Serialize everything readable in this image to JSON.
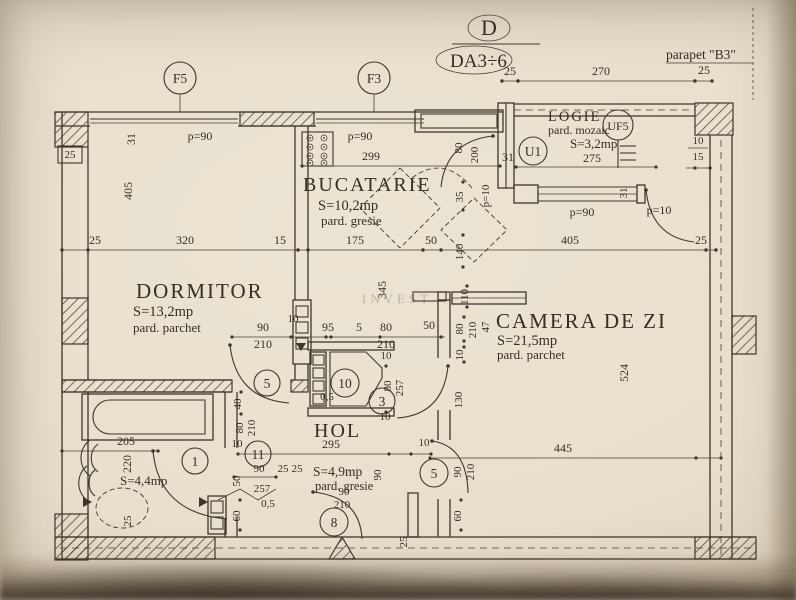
{
  "header": {
    "plan_letter": "D",
    "plan_code": "DA3÷6",
    "parapet_label": "parapet \"B3\""
  },
  "markers": {
    "window_f5": "F5",
    "window_f3": "F3",
    "u1": "U1",
    "uf5": "UF5"
  },
  "doors": {
    "n1": "1",
    "n3": "3",
    "n5": "5",
    "n8": "8",
    "n10": "10",
    "n11": "11"
  },
  "rooms": {
    "dormitor": {
      "name": "DORMITOR",
      "area": "S=13,2mp",
      "floor": "pard. parchet"
    },
    "bucatarie": {
      "name": "BUCATARIE",
      "area": "S=10,2mp",
      "floor": "pard. gresie"
    },
    "camera_zi": {
      "name": "CAMERA DE ZI",
      "area": "S=21,5mp",
      "floor": "pard. parchet"
    },
    "hol": {
      "name": "HOL"
    },
    "hol_intrare": {
      "area": "S=4,9mp",
      "floor": "pard. gresie"
    },
    "baie": {
      "area": "S=4,4mp"
    },
    "logie": {
      "name": "LOGIE",
      "area": "S=3,2mp",
      "floor": "pard. mozaic"
    }
  },
  "dims": {
    "d5": "5",
    "d10": "10",
    "d15": "15",
    "d25": "25",
    "d31": "31",
    "d35": "35",
    "d40": "40",
    "d47": "47",
    "d50": "50",
    "d60": "60",
    "d80": "80",
    "d90": "90",
    "d95": "95",
    "d110": "110",
    "d130": "130",
    "d140": "140",
    "d175": "175",
    "d200": "200",
    "d205": "205",
    "d210": "210",
    "d220": "220",
    "d257": "257",
    "d270": "270",
    "d275": "275",
    "d295": "295",
    "d299": "299",
    "d320": "320",
    "d345": "345",
    "d405": "405",
    "d445": "445",
    "d524": "524",
    "d0_5": "0,5",
    "p90": "p=90",
    "p10": "p=10"
  },
  "annotations": {
    "watermark": "INVEST"
  },
  "colors": {
    "paper": "#e8dfcc",
    "ink": "#3d362c"
  }
}
